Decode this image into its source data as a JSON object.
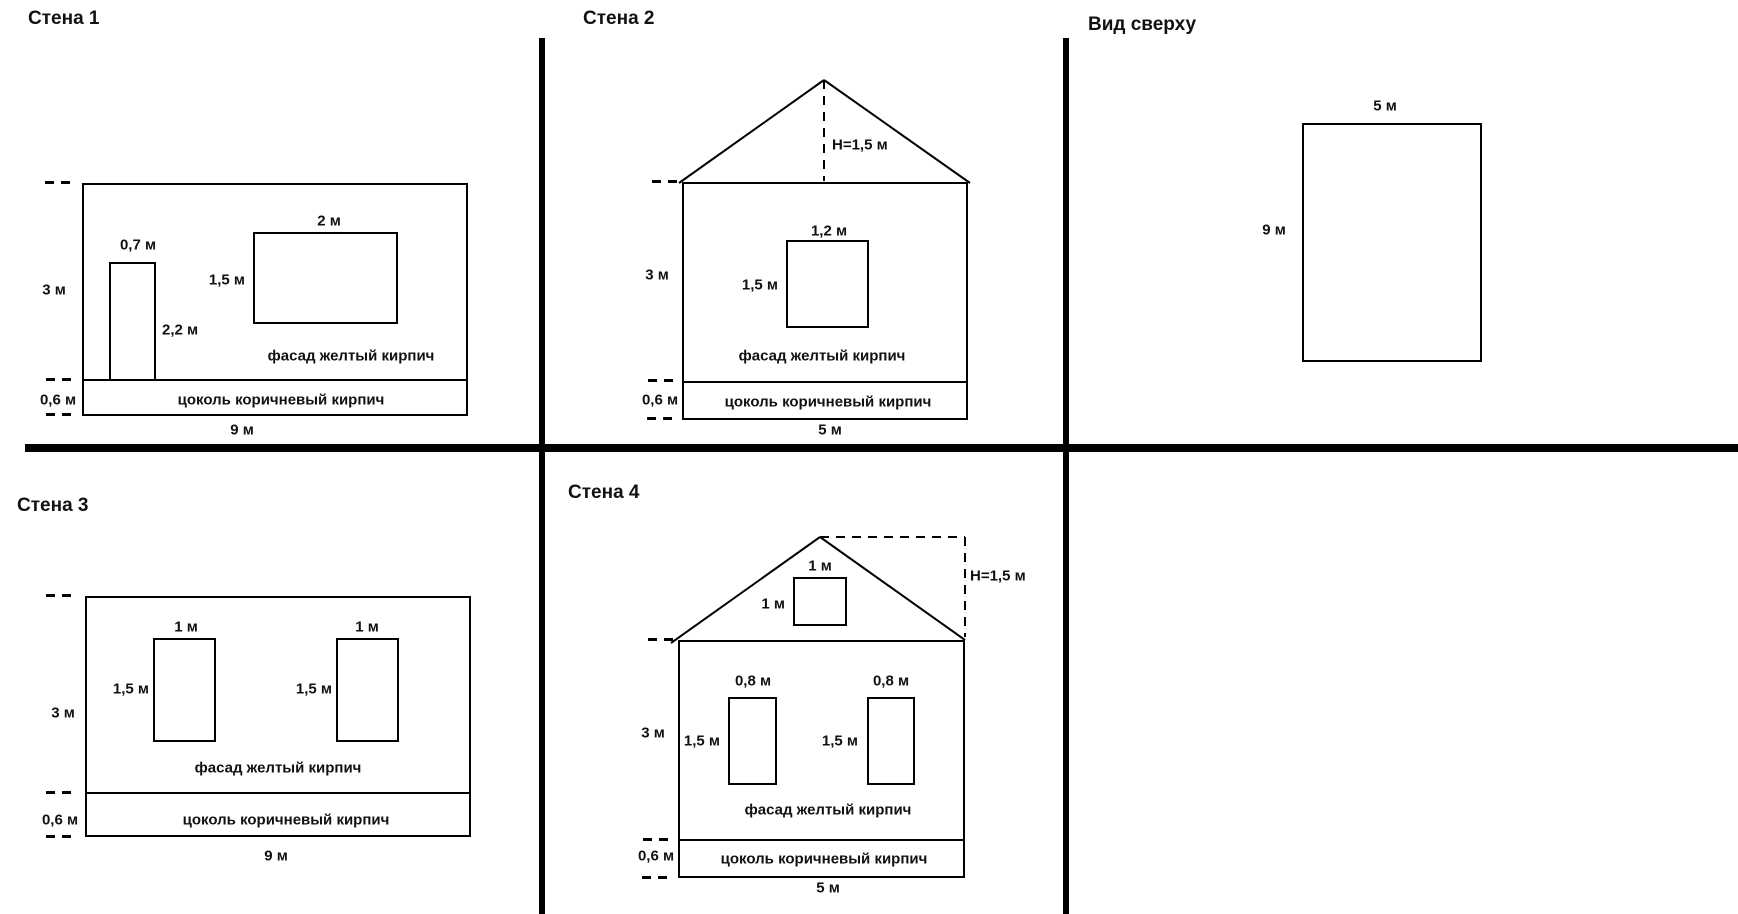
{
  "colors": {
    "background": "#ffffff",
    "line": "#000000",
    "text": "#111111"
  },
  "panels": {
    "wall1": {
      "title": "Стена 1",
      "wall_height": "3 м",
      "wall_width": "9 м",
      "door_width": "0,7 м",
      "door_height": "2,2 м",
      "window_width": "2 м",
      "window_height": "1,5 м",
      "facade_label": "фасад желтый кирпич",
      "plinth_label": "цоколь коричневый кирпич",
      "plinth_height": "0,6 м"
    },
    "wall2": {
      "title": "Стена 2",
      "roof_height": "Н=1,5 м",
      "wall_height": "3 м",
      "wall_width": "5 м",
      "window_width": "1,2 м",
      "window_height": "1,5 м",
      "facade_label": "фасад желтый кирпич",
      "plinth_label": "цоколь коричневый кирпич",
      "plinth_height": "0,6 м"
    },
    "top_view": {
      "title": "Вид сверху",
      "width_label": "5 м",
      "depth_label": "9 м"
    },
    "wall3": {
      "title": "Стена 3",
      "wall_height": "3 м",
      "wall_width": "9 м",
      "window1_width": "1 м",
      "window1_height": "1,5 м",
      "window2_width": "1 м",
      "window2_height": "1,5 м",
      "facade_label": "фасад желтый кирпич",
      "plinth_label": "цоколь коричневый кирпич",
      "plinth_height": "0,6 м"
    },
    "wall4": {
      "title": "Стена 4",
      "roof_height": "Н=1,5 м",
      "gable_window_width": "1 м",
      "gable_window_height": "1 м",
      "wall_height": "3 м",
      "wall_width": "5 м",
      "window1_width": "0,8 м",
      "window1_height": "1,5 м",
      "window2_width": "0,8 м",
      "window2_height": "1,5 м",
      "facade_label": "фасад желтый кирпич",
      "plinth_label": "цоколь коричневый кирпич",
      "plinth_height": "0,6 м"
    }
  }
}
